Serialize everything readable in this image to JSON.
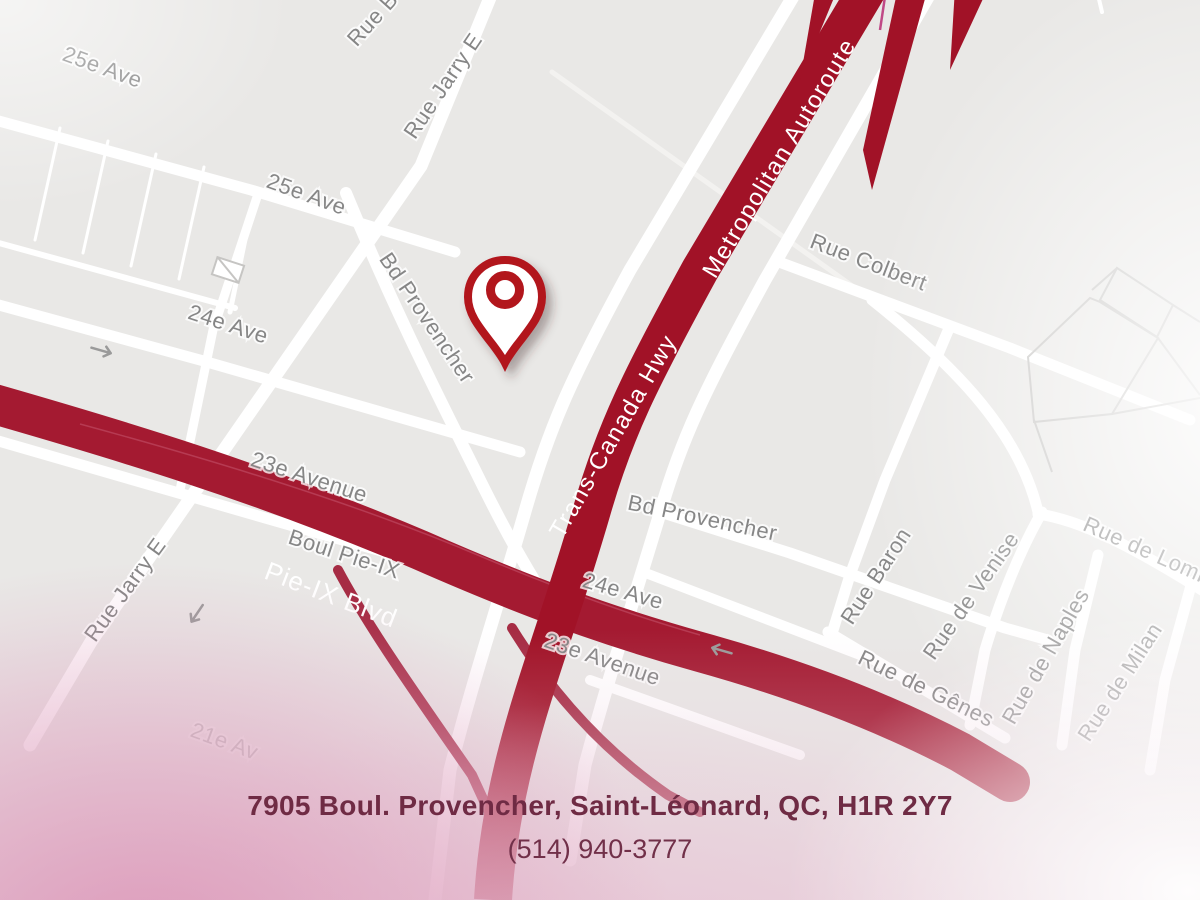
{
  "page": {
    "type": "map-location-view"
  },
  "colors": {
    "bg": "#e9e8e6",
    "hwy": "#a11227",
    "pieix": "#a41a31",
    "ramp": "#a62c44",
    "pin": "#b2121e",
    "label": "#868686",
    "addr": "#6f2b44",
    "pink": "#dfa0bd"
  },
  "map": {
    "pin": {
      "x": 505,
      "y": 297
    },
    "labels": [
      {
        "t": "25e Ave",
        "x": 100,
        "y": 74,
        "r": 20,
        "kind": "minor"
      },
      {
        "t": "25e Ave",
        "x": 304,
        "y": 201,
        "r": 20,
        "kind": "minor"
      },
      {
        "t": "Rue B",
        "x": 378,
        "y": 24,
        "r": -48,
        "kind": "minor"
      },
      {
        "t": "Rue Jarry E",
        "x": 449,
        "y": 90,
        "r": -56,
        "kind": "minor"
      },
      {
        "t": "Bd Provencher",
        "x": 421,
        "y": 322,
        "r": 56,
        "kind": "minor"
      },
      {
        "t": "24e Ave",
        "x": 226,
        "y": 331,
        "r": 18,
        "kind": "minor"
      },
      {
        "t": "23e Avenue",
        "x": 307,
        "y": 484,
        "r": 18,
        "kind": "minor"
      },
      {
        "t": "Boul Pie-IX",
        "x": 342,
        "y": 561,
        "r": 18,
        "kind": "minor"
      },
      {
        "t": "Rue Jarry E",
        "x": 131,
        "y": 594,
        "r": -54,
        "kind": "minor"
      },
      {
        "t": "Rue Colbert",
        "x": 866,
        "y": 269,
        "r": 21,
        "kind": "minor"
      },
      {
        "t": "Bd Provencher",
        "x": 701,
        "y": 525,
        "r": 12,
        "kind": "minor"
      },
      {
        "t": "24e Ave",
        "x": 621,
        "y": 598,
        "r": 16,
        "kind": "minor"
      },
      {
        "t": "23e Avenue",
        "x": 600,
        "y": 666,
        "r": 19,
        "kind": "minor"
      },
      {
        "t": "Rue Baron",
        "x": 882,
        "y": 580,
        "r": -57,
        "kind": "minor"
      },
      {
        "t": "Rue de Venise",
        "x": 977,
        "y": 600,
        "r": -55,
        "kind": "minor"
      },
      {
        "t": "Rue de Naples",
        "x": 1052,
        "y": 660,
        "r": -60,
        "kind": "minor"
      },
      {
        "t": "Rue de Milan",
        "x": 1126,
        "y": 686,
        "r": -57,
        "kind": "minor"
      },
      {
        "t": "Rue de Lombardie",
        "x": 1168,
        "y": 568,
        "r": 24,
        "kind": "minor"
      },
      {
        "t": "Rue de Gênes",
        "x": 923,
        "y": 695,
        "r": 26,
        "kind": "minor"
      },
      {
        "t": "21e Av",
        "x": 222,
        "y": 748,
        "r": 20,
        "kind": "minor",
        "faint": true
      },
      {
        "t": "Metropolitan Autoroute",
        "x": 786,
        "y": 162,
        "r": -59,
        "kind": "hwy"
      },
      {
        "t": "Trans-Canada Hwy",
        "x": 620,
        "y": 440,
        "r": -60,
        "kind": "hwy"
      },
      {
        "t": "Pie-IX Blvd",
        "x": 328,
        "y": 603,
        "r": 21,
        "kind": "hwybig"
      }
    ]
  },
  "footer": {
    "address": "7905 Boul. Provencher, Saint-Léonard, QC, H1R 2Y7",
    "phone": "(514) 940-3777"
  }
}
